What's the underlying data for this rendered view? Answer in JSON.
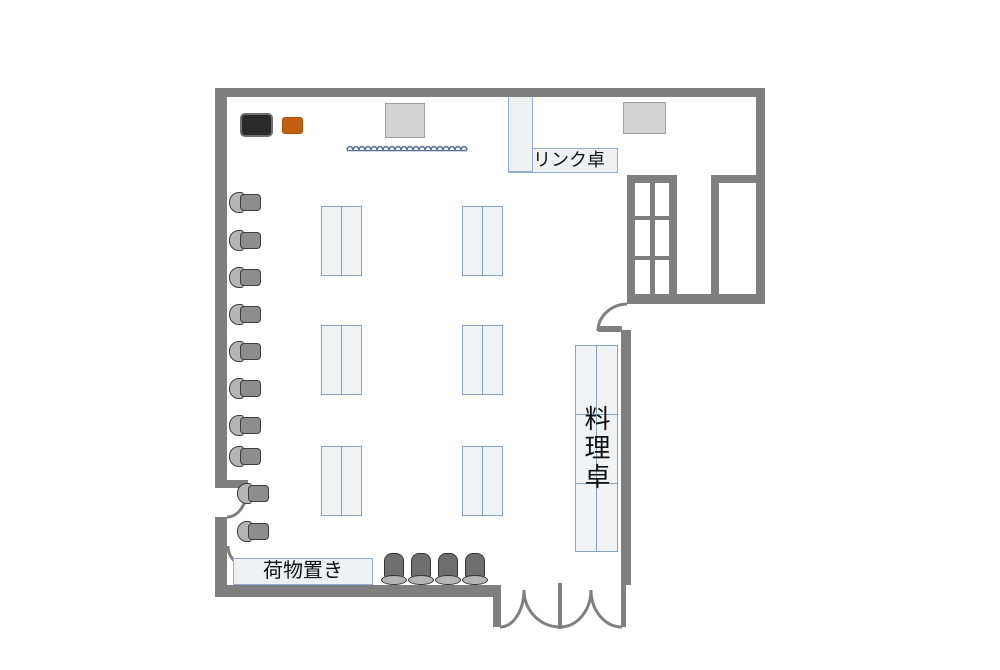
{
  "title": "party room floor plan",
  "labels": {
    "drink_table": "ドリンク卓",
    "cook_table": "料理卓",
    "baggage_area": "荷物置き"
  },
  "counts": {
    "guest_tables": 6,
    "wall_chairs_left": 10,
    "chairs_bottom": 4,
    "window_panes": 6,
    "entrance_double_door_leaves": 2
  },
  "colors": {
    "wall": "#7f7f7f",
    "table_border": "#87a3bd",
    "table_fill": "#f1f2f4",
    "label_border": "#93afd0",
    "label_fill": "#eef0f2",
    "chair_back_dark": "#6f6f6f",
    "chair_seat_light": "#b5b5b5",
    "chair_outline": "#3c3c3c",
    "equipment_black": "#2a2a2a",
    "equipment_orange": "#c2600e",
    "gray_square": "#d3d3d3",
    "squiggle": "#5d6f91",
    "background": "#ffffff"
  }
}
